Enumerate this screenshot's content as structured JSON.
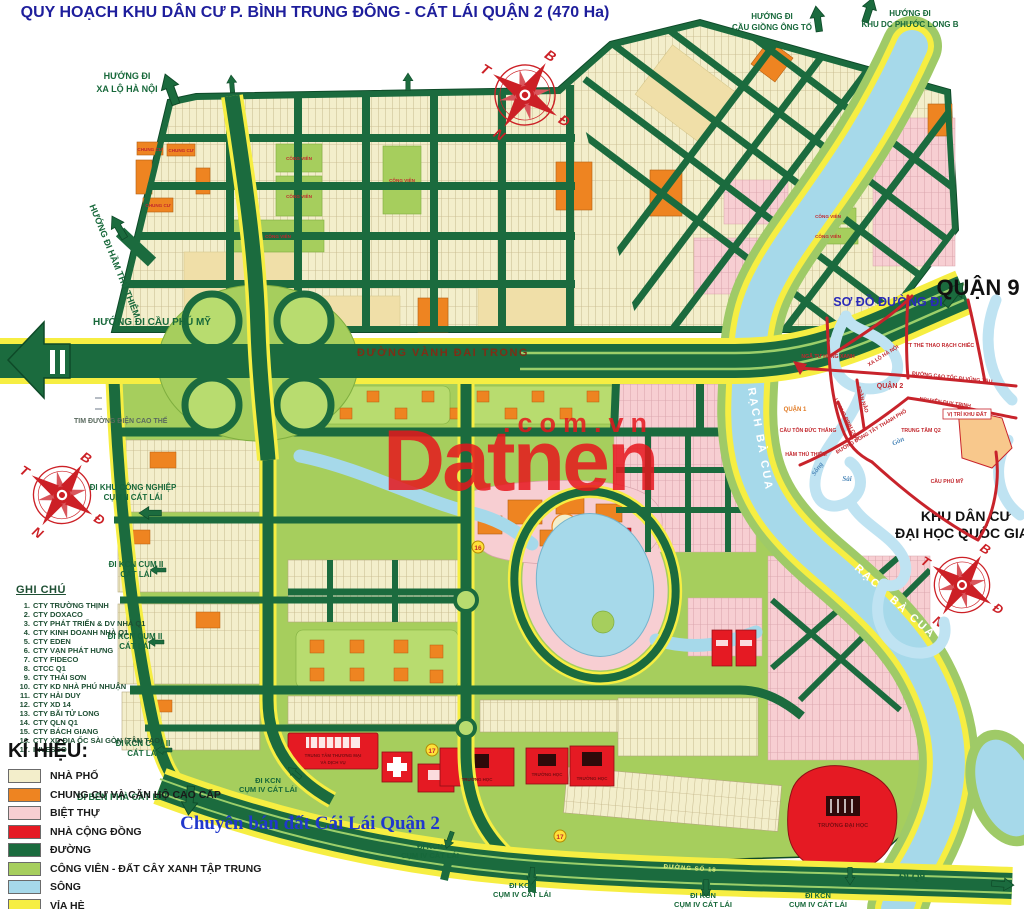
{
  "title": "QUY HOẠCH KHU DÂN CƯ P. BÌNH TRUNG ĐÔNG - CÁT LÁI QUẬN 2 (470 Ha)",
  "watermark": {
    "brand": "Datnen",
    "suffix": ".com.vn"
  },
  "compass": {
    "north": "B",
    "south": "N",
    "east": "Đ",
    "west": "T"
  },
  "directions": {
    "xa_lo_ha_noi": [
      "HƯỚNG ĐI",
      "XA LỘ HÀ NỘI"
    ],
    "ham_thu_thiem": "HƯỚNG ĐI HẦM THỦ THIÊM",
    "cau_phu_my": "HƯỚNG ĐI CẦU PHÚ MỸ",
    "giong_ong_to": [
      "HƯỚNG ĐI",
      "CẦU GIỒNG ÔNG TỐ"
    ],
    "phuoc_long_b": [
      "HƯỚNG ĐI",
      "KHU DC PHƯỚC LONG B"
    ],
    "kcn_2": [
      "ĐI KHU CÔNG NGHIỆP",
      "CỤM II CÁT LÁI"
    ],
    "kcn_2_short": [
      "ĐI KCN CỤM II",
      "CÁT LÁI"
    ],
    "ben_pha": "ĐI BẾN PHÀ CÁT LÁI",
    "kcn_4": [
      "ĐI KCN",
      "CỤM IV CÁT LÁI"
    ],
    "q9": "ĐI Q9"
  },
  "roads": {
    "vanh_dai_trong": "ĐƯỜNG VÀNH ĐAI TRONG",
    "so_18": "ĐƯỜNG SỐ 18",
    "tim_dien": "TIM ĐƯỜNG ĐIỆN CAO THẾ"
  },
  "water": {
    "rach_ba_cua": "RẠCH BÀ CUA"
  },
  "areas": {
    "quan_9": "QUẬN 9",
    "khu_dai_hoc": [
      "KHU DÂN CƯ",
      "ĐẠI HỌC QUỐC GIA"
    ],
    "cong_vien": "CÔNG VIÊN",
    "chung_cu": "CHUNG CƯ",
    "truong_dai_hoc": "TRƯỜNG ĐẠI HỌC",
    "truong_hoc": "TRƯỜNG HỌC",
    "tttm": [
      "TRUNG TÂM THƯƠNG MẠI",
      "VÀ DỊCH VỤ"
    ]
  },
  "inset": {
    "title": "SƠ ĐỒ ĐƯỜNG ĐI",
    "labels": {
      "nga_tu_hang_xanh": "NGÃ TƯ HÀNG XANH",
      "xa_lo_ha_noi": "XA LỘ HÀ NỘI",
      "tt_the_thao": "TT THỂ THAO RẠCH CHIẾC",
      "quan_2": "QUẬN 2",
      "quan_1": "QUẬN 1",
      "cao_toc": "ĐƯỜNG CAO TỐC ĐI VŨNG TÀU",
      "tran_nao": "TRẦN NÃO",
      "luong_dinh_cua": "LƯƠNG ĐỊNH CỦA",
      "dong_tay": "ĐƯỜNG ĐÔNG TÂY THÀNH PHỐ",
      "nguyen_duy_trinh": "NGUYỄN DUY TRINH",
      "vi_tri": "VỊ TRÍ KHU ĐẤT",
      "trung_tam_q2": "TRUNG TÂM Q2",
      "cau_ton_duc_thang": "CẦU TÔN ĐỨC THẮNG",
      "ham_thu_thiem": "HẦM THỦ THIÊM",
      "cau_phu_my": "CẦU PHÚ MỸ",
      "song": "Sông",
      "sai": "Sài",
      "gon": "Gòn"
    }
  },
  "notes": {
    "heading": "GHI CHÚ",
    "items": [
      {
        "no": "1.",
        "text": "CTY TRƯỜNG THỊNH"
      },
      {
        "no": "2.",
        "text": "CTY DOXACO"
      },
      {
        "no": "3.",
        "text": "CTY PHÁT TRIỂN & DV NHÀ Q1"
      },
      {
        "no": "4.",
        "text": "CTY KINH DOANH NHÀ Q1"
      },
      {
        "no": "5.",
        "text": "CTY EDEN"
      },
      {
        "no": "6.",
        "text": "CTY VẠN PHÁT HƯNG"
      },
      {
        "no": "7.",
        "text": "CTY FIDECO"
      },
      {
        "no": "8.",
        "text": "CTCC Q1"
      },
      {
        "no": "9.",
        "text": "CTY THÁI SƠN"
      },
      {
        "no": "10.",
        "text": "CTY KD NHÀ PHÚ NHUẬN"
      },
      {
        "no": "11.",
        "text": "CTY HẢI DUY"
      },
      {
        "no": "12.",
        "text": "CTY XD 14"
      },
      {
        "no": "13.",
        "text": "CTY BÃI TỬ LONG"
      },
      {
        "no": "14.",
        "text": "CTY QLN Q1"
      },
      {
        "no": "15.",
        "text": "CTY BÁCH GIANG"
      },
      {
        "no": "16.",
        "text": "CTY XD ĐỊA ỐC SÀI GÒN (TÂN TẠO)"
      },
      {
        "no": "17.",
        "text": "INVESCO"
      }
    ]
  },
  "legend": {
    "heading": "KÍ HIỆU:",
    "items": [
      {
        "label": "NHÀ PHỐ",
        "color": "#f3eecb"
      },
      {
        "label": "CHUNG CƯ VÀ CĂN HỘ CAO CẤP",
        "color": "#ee8421"
      },
      {
        "label": "BIỆT THỰ",
        "color": "#f7ced2"
      },
      {
        "label": "NHÀ CỘNG ĐỒNG",
        "color": "#e51a23"
      },
      {
        "label": "ĐƯỜNG",
        "color": "#1b6b3e"
      },
      {
        "label": "CÔNG VIÊN - ĐẤT CÂY XANH TẬP TRUNG",
        "color": "#a6ce5d"
      },
      {
        "label": "SÔNG",
        "color": "#a6d9ea"
      },
      {
        "label": "VỈA HÈ",
        "color": "#f6ee42"
      }
    ]
  },
  "footer": "Chuyên bán đất Cái Lái Quận 2",
  "markers": [
    {
      "label": "16"
    },
    {
      "label": "17"
    },
    {
      "label": "17"
    }
  ]
}
